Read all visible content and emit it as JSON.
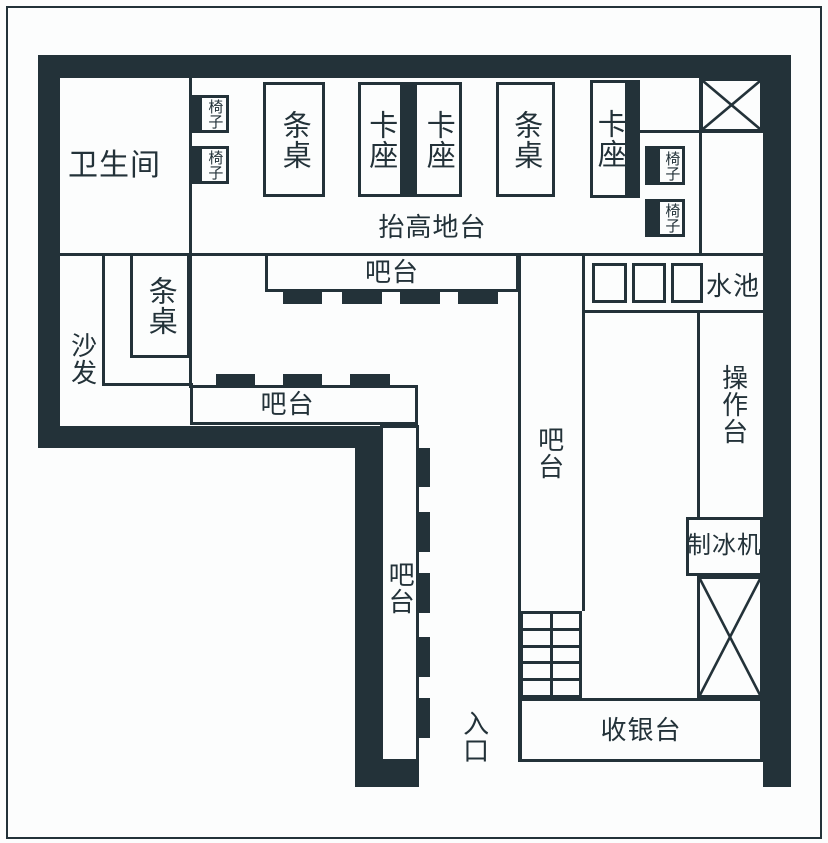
{
  "palette": {
    "ink": "#233239",
    "paper": "#fcfdfd"
  },
  "labels": {
    "restroom": "卫生间",
    "chair": "椅子",
    "long_table": "条桌",
    "booth": "卡座",
    "raised_platform": "抬高地台",
    "bar": "吧台",
    "sofa": "沙发",
    "sink": "水池",
    "worktop": "操作台",
    "ice_machine": "制冰机",
    "cashier": "收银台",
    "entrance": "入口"
  }
}
